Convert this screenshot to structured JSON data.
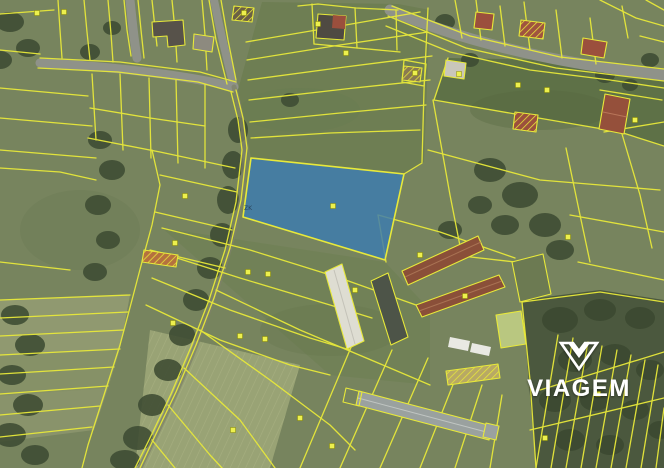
{
  "watermark": {
    "label": "VIAGEM",
    "icon": "viagem-gem-icon"
  },
  "map": {
    "parcel_label": "ZK"
  },
  "colors": {
    "parcel_line": "#e8e93a",
    "highlight_fill": "#3c7bb0",
    "highlight_stroke": "#e8e93a",
    "marker": "#edf04d",
    "road": "#8f9289",
    "field_base": "#77845e",
    "field_light": "#a6ab80",
    "field_dark": "#5e7147",
    "trees": "#3e4c33",
    "roof_red": "#9b4f3d",
    "roof_brown": "#8a4f39",
    "roof_dark": "#4d5448",
    "roof_light": "#deddd2",
    "watermark": "#ffffff"
  }
}
